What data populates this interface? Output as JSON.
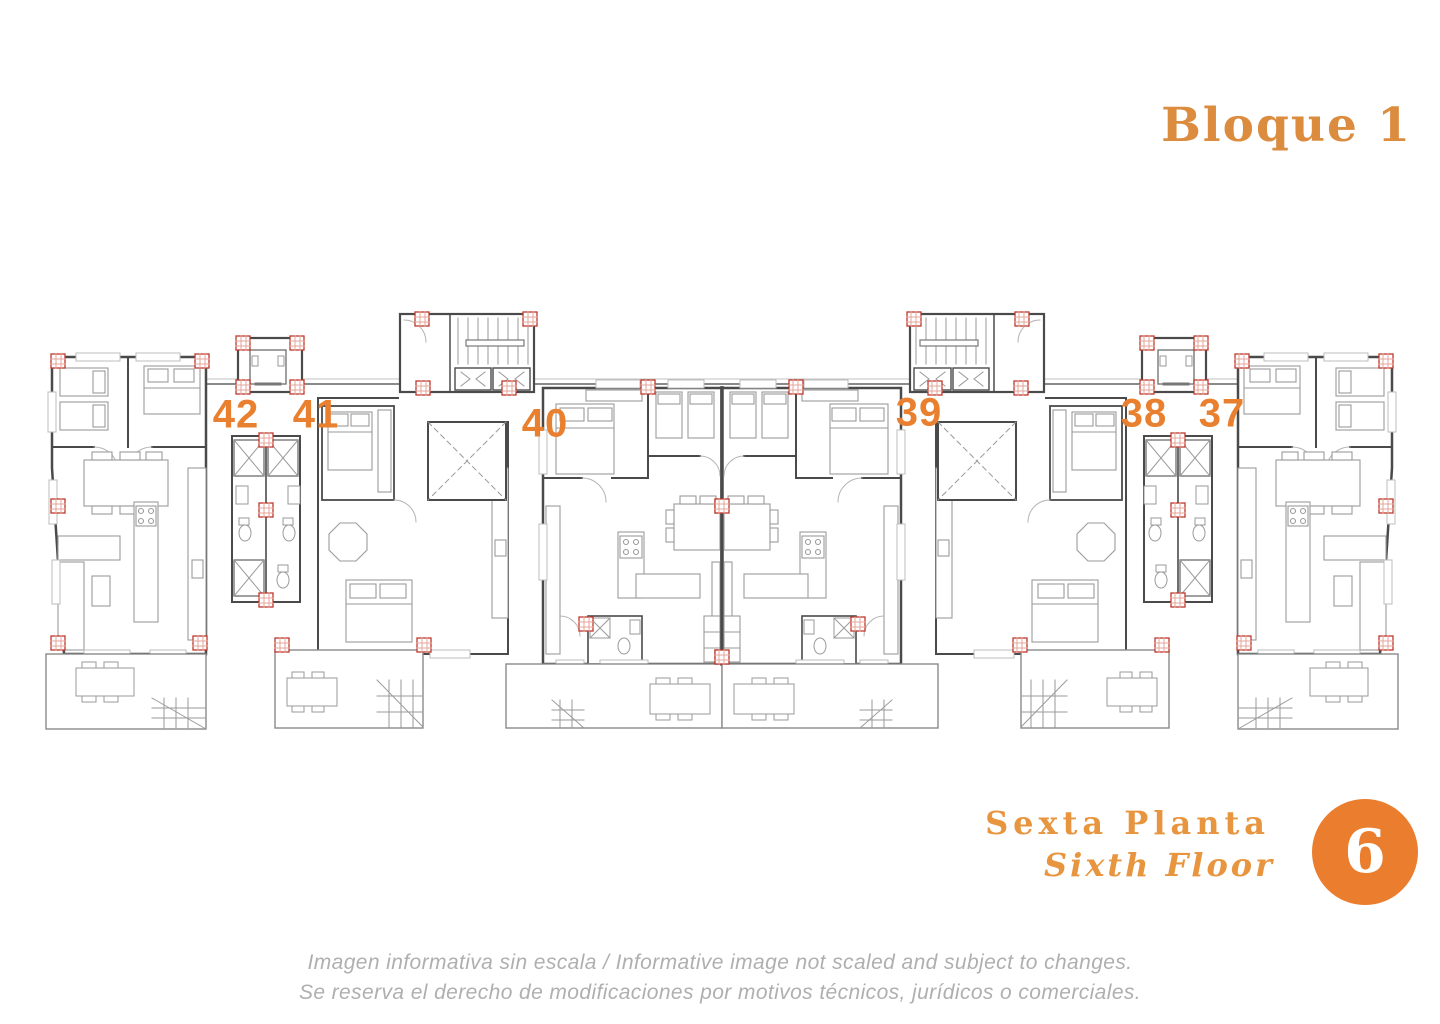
{
  "title": {
    "text": "Bloque 1",
    "color": "#DB8C3F"
  },
  "plan": {
    "label_color": "#E8802F",
    "pillar_color": "#C0392B",
    "wall_color": "#4A4A4A",
    "units": [
      {
        "number": "42",
        "x": 236,
        "y": 415
      },
      {
        "number": "41",
        "x": 316,
        "y": 415
      },
      {
        "number": "40",
        "x": 545,
        "y": 424
      },
      {
        "number": "39",
        "x": 919,
        "y": 413
      },
      {
        "number": "38",
        "x": 1144,
        "y": 414
      },
      {
        "number": "37",
        "x": 1222,
        "y": 414
      }
    ]
  },
  "floor_label": {
    "es": "Sexta Planta",
    "en": "Sixth Floor",
    "color": "#E8953F"
  },
  "floor_badge": {
    "floor_number": "6",
    "circle_color": "#EA7D2E",
    "text_color": "#FFFFFF"
  },
  "disclaimer": {
    "color": "#AFAFAF",
    "line1": "Imagen informativa sin escala /  Informative image not scaled and subject to changes.",
    "line2": "Se reserva el derecho de modificaciones por motivos técnicos, jurídicos o comerciales."
  }
}
